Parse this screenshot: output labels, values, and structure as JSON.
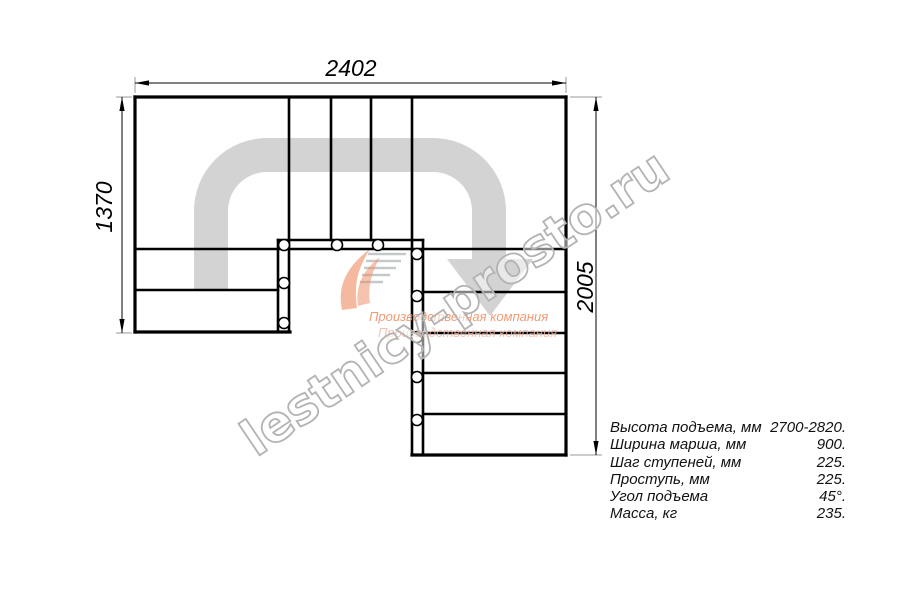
{
  "dimensions": {
    "width_top": "2402",
    "height_left": "1370",
    "height_right": "2005"
  },
  "specs": {
    "rows": [
      {
        "label": "Высота подъема, мм",
        "value": "2700-2820."
      },
      {
        "label": "Ширина марша, мм",
        "value": "900."
      },
      {
        "label": "Шаг ступеней, мм",
        "value": "225."
      },
      {
        "label": "Проступь, мм",
        "value": "225."
      },
      {
        "label": "Угол подъема",
        "value": "45°."
      },
      {
        "label": "Масса, кг",
        "value": "235."
      }
    ]
  },
  "watermark": {
    "site": "lestnicy-prosto.ru",
    "company_line_1": "Производственная компания",
    "company_line_2": "Производственная компания"
  },
  "colors": {
    "line": "#000000",
    "extension": "#9a9a9a",
    "path_arrow": "#d3d3d3",
    "watermark_stroke": "#b3b3b3",
    "logo_orange": "#ed8a5e",
    "logo_orange_light": "#f2b49e"
  }
}
